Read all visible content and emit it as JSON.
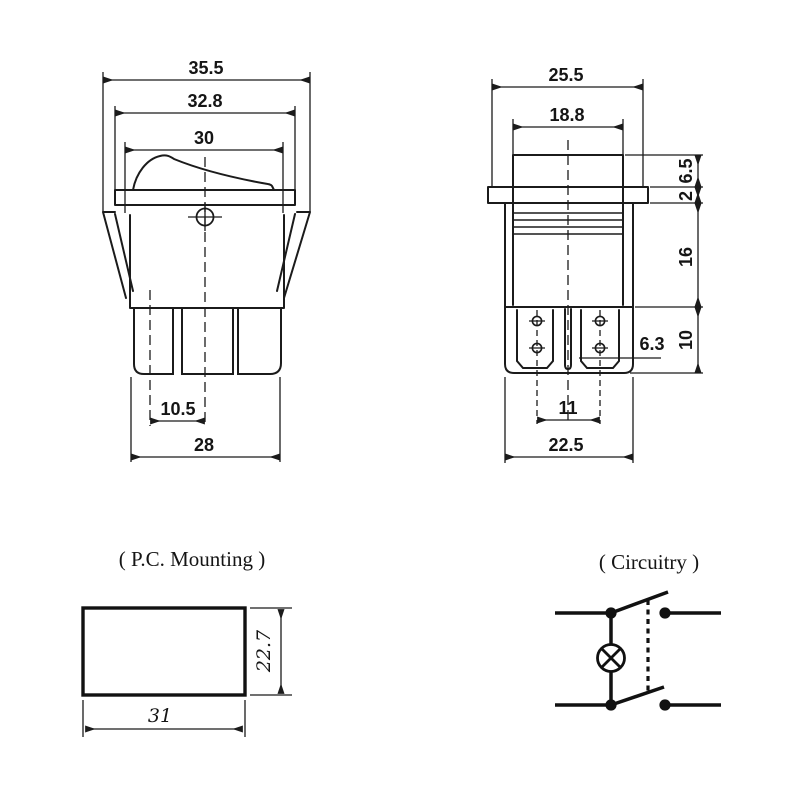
{
  "sheet": {
    "background": "#ffffff",
    "ink": "#1b1b1b",
    "description": "Rocker switch dimensional drawing"
  },
  "front_view": {
    "dims": {
      "overall_width": "35.5",
      "bezel_width": "32.8",
      "rocker_width": "30",
      "terminal_pitch": "10.5",
      "body_width": "28"
    }
  },
  "side_view": {
    "dims": {
      "overall_depth": "25.5",
      "rocker_depth": "18.8",
      "bezel_height": "6.5",
      "flange_thickness": "2",
      "body_height": "16",
      "terminal_zone_height": "10",
      "terminal_width": "6.3",
      "terminal_pitch": "11",
      "body_depth": "22.5"
    }
  },
  "pc_mounting": {
    "title": "( P.C. Mounting )",
    "dims": {
      "cutout_width": "31",
      "cutout_height": "22.7"
    }
  },
  "circuitry": {
    "title": "( Circuitry )"
  }
}
